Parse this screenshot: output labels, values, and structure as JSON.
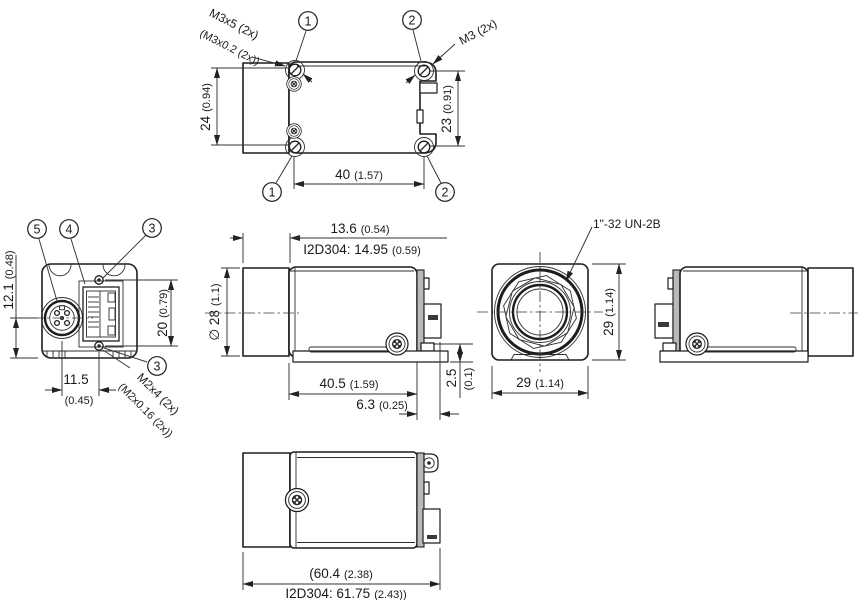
{
  "drawing": {
    "title": "industrial-camera-dimensional-drawing",
    "background": "#ffffff",
    "line_color": "#1d1d1d",
    "views": {
      "top": {
        "callout_1": "1",
        "callout_2": "2",
        "label_m3x5": "M3x5 (2x)",
        "label_m3x5_pitch": "(M3x0.2 (2x))",
        "label_m3": "M3 (2x)",
        "dim_left_mm": "24",
        "dim_left_in": "(0.94)",
        "dim_right_mm": "23",
        "dim_right_in": "(0.91)",
        "dim_bottom_mm": "40",
        "dim_bottom_in": "(1.57)"
      },
      "rear": {
        "callout_5": "5",
        "callout_4": "4",
        "callout_3": "3",
        "dim_center_mm": "12.1",
        "dim_center_in": "(0.48)",
        "dim_screws_mm": "20",
        "dim_screws_in": "(0.79)",
        "dim_conn_mm": "11.5",
        "dim_conn_in": "(0.45)",
        "label_m2x4": "M2x4 (2x)",
        "label_m2x4_pitch": "(M2x0.16 (2x))"
      },
      "side": {
        "dim_lens_mm": "13.6",
        "dim_lens_in": "(0.54)",
        "dim_lens_i2d_mm": "I2D304: 14.95",
        "dim_lens_i2d_in": "(0.59)",
        "dim_dia_mm": "∅ 28",
        "dim_dia_in": "(1.1)",
        "dim_body_mm": "40.5",
        "dim_body_in": "(1.59)",
        "dim_conn_mm": "6.3",
        "dim_conn_in": "(0.25)",
        "dim_foot_mm": "2.5",
        "dim_foot_in": "(0.1)"
      },
      "front": {
        "label_thread": "1\"-32 UN-2B",
        "dim_height_mm": "29",
        "dim_height_in": "(1.14)",
        "dim_width_mm": "29",
        "dim_width_in": "(1.14)"
      },
      "bottom": {
        "dim_len_mm": "(60.4",
        "dim_len_in": "(2.38)",
        "dim_len_i2d_mm": "I2D304: 61.75",
        "dim_len_i2d_in": "(2.43))"
      }
    }
  }
}
